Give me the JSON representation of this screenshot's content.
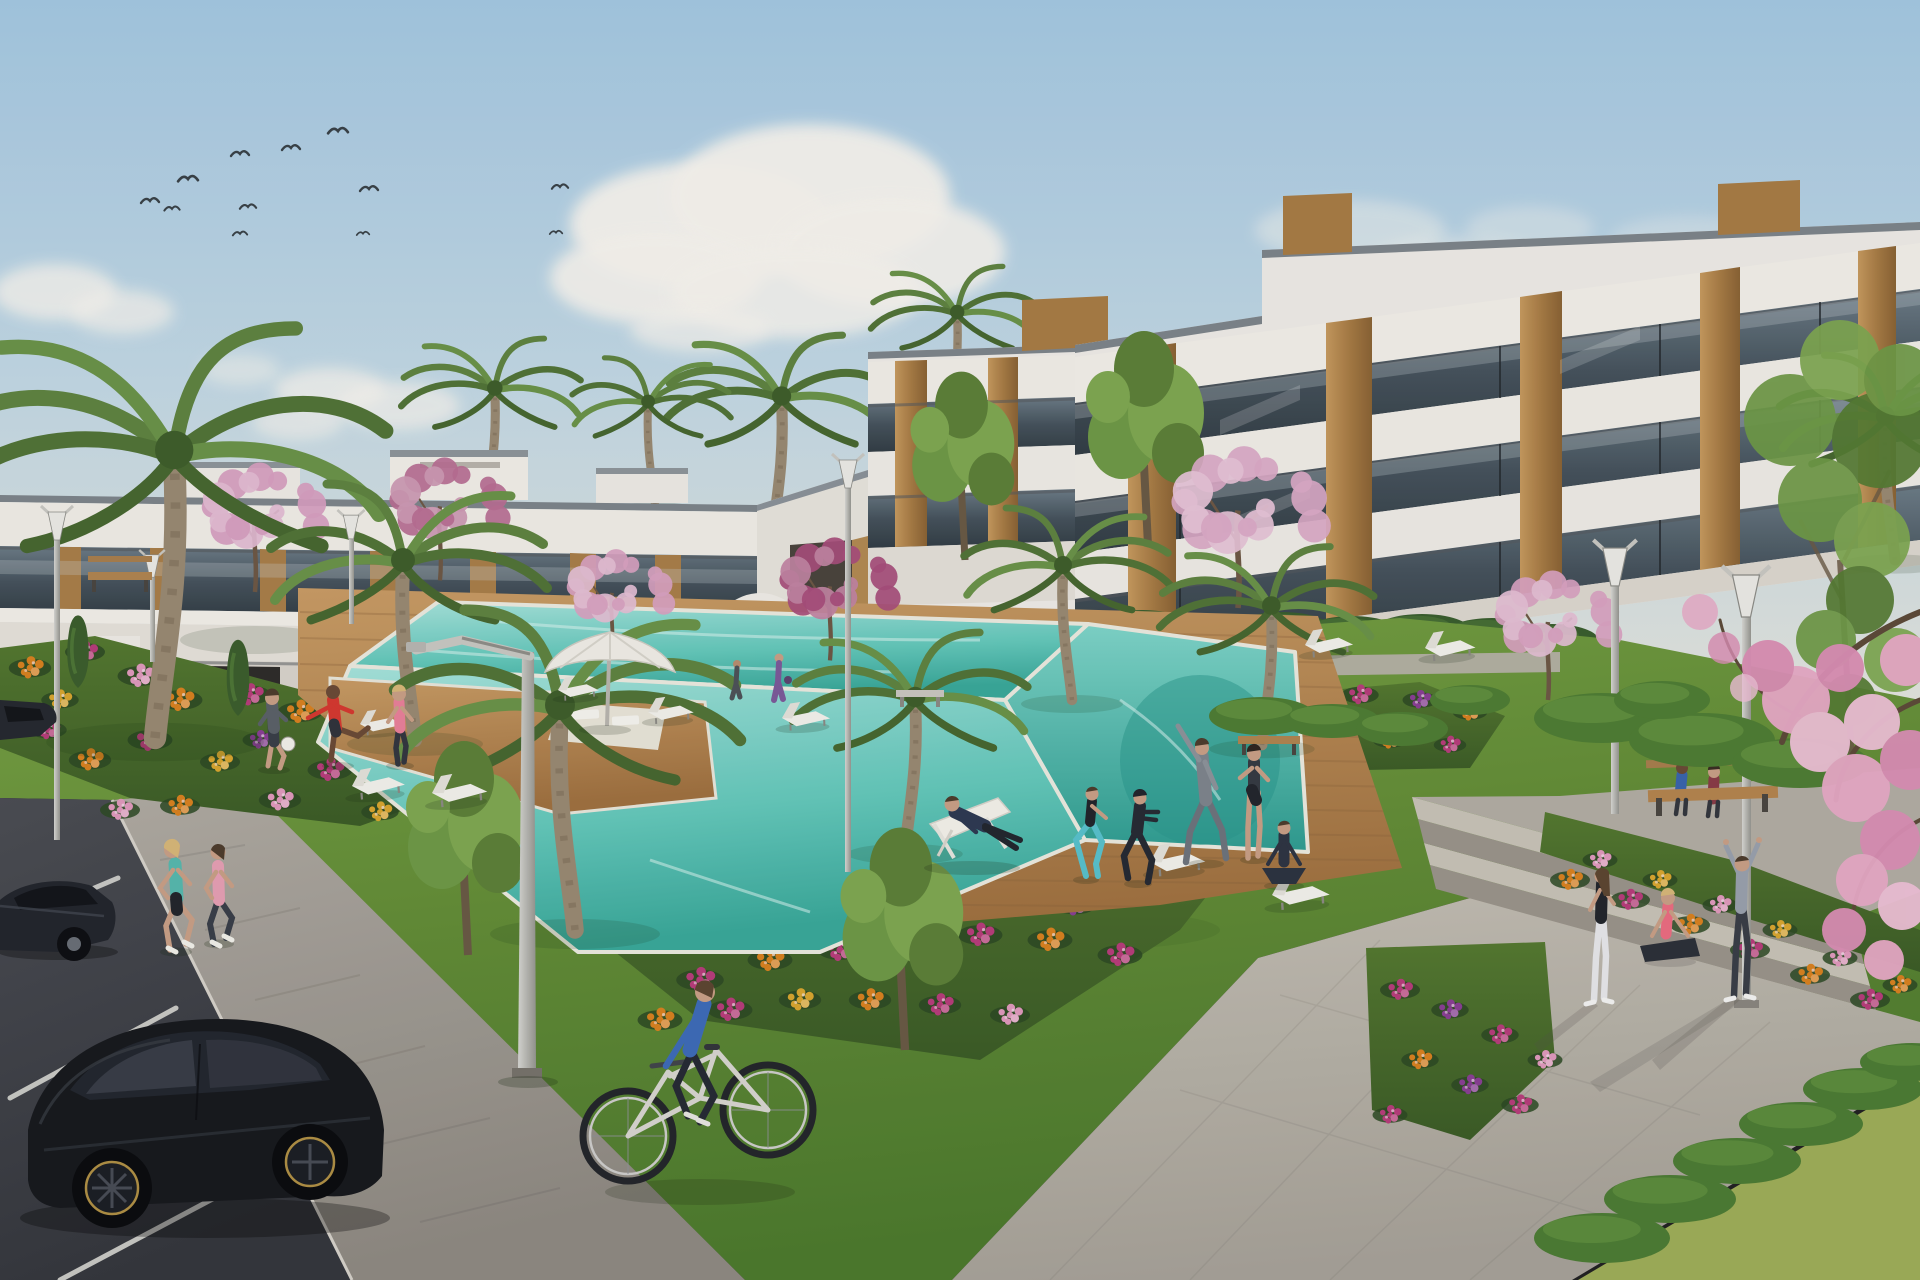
{
  "meta": {
    "title": "Residential complex architectural render",
    "description": "Sunny 3D architectural rendering of a modern white apartment complex with glass balconies and wood panels, communal garden, turquoise swimming pool with wooden deck, flower beds, palm and cherry-blossom trees, parking with black cars, joggers, a cyclist and residents exercising on the lawn."
  },
  "labels": {
    "sky": "blue sky with clouds and birds",
    "building_left": "two-storey white apartment wing",
    "building_right": "three-storey white apartment building",
    "pool": "communal swimming pool with wooden deck",
    "garden": "landscaped lawn and flower beds",
    "parking": "parking lot with dark cars",
    "plaza": "paved plaza with steps",
    "people": "residents exercising, jogging and relaxing"
  },
  "palette": {
    "sky_top": "#a6c9e2",
    "sky_low": "#dde4e2",
    "white_wall": "#f0ede6",
    "wall_shade": "#d9d4cb",
    "glass": "#4a5862",
    "wood": "#b98a50",
    "lawn": "#6f9a3e",
    "hedge_dark": "#3a5e2d",
    "hedge_bright": "#4f7d33",
    "deck": "#b88856",
    "water": "#5cc4b6",
    "pavement": "#b7b2a8",
    "asphalt": "#42444a",
    "blossom": "#d9a0bd",
    "car": "#17191d"
  },
  "scene": {
    "flower_colors": {
      "o": "#d9821f",
      "m": "#b83d7a",
      "p": "#e09abc",
      "u": "#8a3f93",
      "g": "#d9a62e",
      "c": "#c24a5e"
    },
    "clouds": [
      [
        700,
        225,
        130,
        62,
        0.95
      ],
      [
        810,
        196,
        140,
        72,
        0.95
      ],
      [
        890,
        252,
        115,
        55,
        0.9
      ],
      [
        655,
        278,
        105,
        46,
        0.9
      ],
      [
        795,
        292,
        125,
        46,
        0.85
      ],
      [
        700,
        330,
        70,
        22,
        0.7
      ],
      [
        55,
        292,
        62,
        28,
        0.8
      ],
      [
        122,
        312,
        52,
        22,
        0.7
      ],
      [
        330,
        390,
        56,
        22,
        0.75
      ],
      [
        398,
        406,
        62,
        24,
        0.7
      ],
      [
        298,
        422,
        46,
        18,
        0.6
      ],
      [
        1000,
        386,
        46,
        16,
        0.5
      ],
      [
        1062,
        400,
        42,
        14,
        0.45
      ],
      [
        1350,
        230,
        95,
        30,
        0.45
      ],
      [
        1455,
        262,
        85,
        26,
        0.4
      ],
      [
        1530,
        228,
        64,
        22,
        0.35
      ],
      [
        1690,
        240,
        80,
        24,
        0.3
      ],
      [
        240,
        370,
        40,
        16,
        0.5
      ]
    ],
    "birds": [
      [
        150,
        200,
        1
      ],
      [
        188,
        178,
        1.1
      ],
      [
        172,
        208,
        0.85
      ],
      [
        240,
        153,
        1
      ],
      [
        248,
        206,
        0.9
      ],
      [
        291,
        147,
        1
      ],
      [
        338,
        130,
        1.1
      ],
      [
        369,
        188,
        1
      ],
      [
        240,
        233,
        0.8
      ],
      [
        363,
        233,
        0.7
      ],
      [
        560,
        186,
        0.9
      ],
      [
        556,
        232,
        0.7
      ]
    ],
    "palms_bg": [
      [
        772,
        540,
        1.6,
        1
      ],
      [
        950,
        420,
        1.2,
        1
      ],
      [
        655,
        505,
        1.15,
        -1
      ],
      [
        487,
        505,
        1.3,
        1
      ]
    ],
    "palms_fg": [
      [
        155,
        738,
        3.2,
        1
      ],
      [
        415,
        740,
        2.0,
        -1
      ],
      [
        575,
        930,
        2.5,
        -1
      ],
      [
        905,
        850,
        1.7,
        1
      ],
      [
        1072,
        700,
        1.5,
        -1
      ],
      [
        1262,
        745,
        1.55,
        1
      ],
      [
        1895,
        560,
        1.6,
        -1
      ]
    ],
    "blossoms": [
      [
        255,
        520,
        1.0,
        "#d79fc0"
      ],
      [
        440,
        512,
        0.95,
        "#b96f92"
      ],
      [
        612,
        598,
        0.85,
        "#d9a3c1"
      ],
      [
        830,
        592,
        0.95,
        "#a84f7b"
      ],
      [
        1238,
        518,
        1.25,
        "#dcaac6"
      ],
      [
        1548,
        628,
        1.0,
        "#d9a3c1"
      ]
    ],
    "greens_bg": [
      [
        965,
        560,
        1.1
      ],
      [
        1148,
        545,
        1.25
      ]
    ],
    "greens_fg": [
      [
        468,
        955,
        1.25
      ],
      [
        905,
        1050,
        1.3
      ]
    ],
    "conifers": [
      [
        78,
        688,
        1
      ],
      [
        238,
        716,
        1.05
      ],
      [
        398,
        754,
        1.1
      ],
      [
        478,
        788,
        1.0
      ],
      [
        560,
        708,
        0.8
      ],
      [
        1005,
        700,
        0.7
      ]
    ],
    "hedges_dark": [
      [
        722,
        626,
        46,
        17
      ],
      [
        792,
        631,
        50,
        19
      ],
      [
        862,
        626,
        47,
        17
      ],
      [
        932,
        630,
        51,
        19
      ],
      [
        1002,
        626,
        47,
        17
      ],
      [
        1072,
        631,
        51,
        19
      ],
      [
        1142,
        627,
        49,
        17
      ],
      [
        1212,
        633,
        51,
        19
      ],
      [
        1282,
        629,
        49,
        17
      ],
      [
        1352,
        635,
        51,
        19
      ],
      [
        1422,
        631,
        49,
        17
      ],
      [
        1492,
        637,
        51,
        19
      ],
      [
        1552,
        641,
        47,
        17
      ],
      [
        22,
        718,
        58,
        21
      ],
      [
        112,
        724,
        63,
        23
      ],
      [
        212,
        728,
        60,
        21
      ],
      [
        312,
        734,
        62,
        23
      ],
      [
        412,
        740,
        58,
        21
      ],
      [
        502,
        738,
        53,
        19
      ],
      [
        592,
        733,
        48,
        17
      ],
      [
        662,
        728,
        43,
        15
      ]
    ],
    "hedges_bright": [
      [
        1602,
        718,
        68,
        25
      ],
      [
        1702,
        740,
        73,
        27
      ],
      [
        1800,
        763,
        68,
        25
      ],
      [
        1662,
        700,
        48,
        19
      ],
      [
        1262,
        716,
        53,
        19
      ],
      [
        1332,
        721,
        48,
        17
      ],
      [
        1402,
        729,
        46,
        17
      ],
      [
        1470,
        700,
        40,
        15
      ]
    ],
    "hedges_corner": [
      [
        1602,
        1238,
        68,
        25
      ],
      [
        1670,
        1199,
        66,
        24
      ],
      [
        1737,
        1161,
        64,
        23
      ],
      [
        1801,
        1124,
        62,
        22
      ],
      [
        1863,
        1089,
        60,
        21
      ],
      [
        1912,
        1062,
        52,
        19
      ]
    ],
    "flowers": [
      [
        30,
        668,
        17,
        "o"
      ],
      [
        85,
        652,
        16,
        "m"
      ],
      [
        140,
        676,
        18,
        "p"
      ],
      [
        60,
        700,
        15,
        "g"
      ],
      [
        180,
        700,
        18,
        "o"
      ],
      [
        250,
        695,
        17,
        "m"
      ],
      [
        300,
        712,
        18,
        "o"
      ],
      [
        360,
        730,
        17,
        "p"
      ],
      [
        150,
        740,
        18,
        "m"
      ],
      [
        90,
        760,
        17,
        "o"
      ],
      [
        220,
        762,
        16,
        "g"
      ],
      [
        330,
        770,
        18,
        "m"
      ],
      [
        420,
        760,
        16,
        "o"
      ],
      [
        460,
        788,
        16,
        "m"
      ],
      [
        280,
        800,
        17,
        "p"
      ],
      [
        180,
        806,
        16,
        "o"
      ],
      [
        380,
        812,
        15,
        "g"
      ],
      [
        120,
        810,
        16,
        "p"
      ],
      [
        48,
        730,
        15,
        "m"
      ],
      [
        260,
        740,
        14,
        "u"
      ],
      [
        700,
        880,
        20,
        "m"
      ],
      [
        760,
        840,
        19,
        "o"
      ],
      [
        820,
        800,
        18,
        "p"
      ],
      [
        880,
        790,
        18,
        "m"
      ],
      [
        940,
        780,
        18,
        "o"
      ],
      [
        1000,
        775,
        18,
        "m"
      ],
      [
        1060,
        770,
        17,
        "g"
      ],
      [
        1120,
        780,
        18,
        "m"
      ],
      [
        1180,
        790,
        18,
        "o"
      ],
      [
        1240,
        805,
        18,
        "m"
      ],
      [
        680,
        930,
        19,
        "o"
      ],
      [
        740,
        900,
        18,
        "p"
      ],
      [
        800,
        880,
        18,
        "g"
      ],
      [
        860,
        860,
        18,
        "m"
      ],
      [
        920,
        850,
        18,
        "o"
      ],
      [
        980,
        840,
        17,
        "p"
      ],
      [
        1040,
        835,
        18,
        "m"
      ],
      [
        1100,
        845,
        18,
        "o"
      ],
      [
        1160,
        860,
        18,
        "m"
      ],
      [
        1220,
        880,
        18,
        "p"
      ],
      [
        700,
        980,
        19,
        "m"
      ],
      [
        770,
        960,
        18,
        "o"
      ],
      [
        840,
        950,
        18,
        "m"
      ],
      [
        910,
        940,
        17,
        "g"
      ],
      [
        980,
        935,
        18,
        "m"
      ],
      [
        1050,
        940,
        18,
        "o"
      ],
      [
        1120,
        955,
        18,
        "m"
      ],
      [
        660,
        1020,
        18,
        "o"
      ],
      [
        730,
        1010,
        18,
        "m"
      ],
      [
        800,
        1000,
        17,
        "g"
      ],
      [
        870,
        1000,
        17,
        "o"
      ],
      [
        940,
        1005,
        17,
        "m"
      ],
      [
        1010,
        1015,
        16,
        "p"
      ],
      [
        1075,
        905,
        17,
        "u"
      ],
      [
        945,
        895,
        16,
        "u"
      ],
      [
        1240,
        710,
        15,
        "u"
      ],
      [
        1300,
        700,
        15,
        "o"
      ],
      [
        1360,
        695,
        15,
        "m"
      ],
      [
        1420,
        700,
        14,
        "u"
      ],
      [
        1470,
        712,
        14,
        "o"
      ],
      [
        1270,
        740,
        14,
        "m"
      ],
      [
        1330,
        735,
        14,
        "u"
      ],
      [
        1390,
        740,
        14,
        "o"
      ],
      [
        1450,
        745,
        13,
        "m"
      ],
      [
        1570,
        880,
        16,
        "o"
      ],
      [
        1630,
        900,
        16,
        "m"
      ],
      [
        1690,
        925,
        16,
        "o"
      ],
      [
        1750,
        950,
        16,
        "m"
      ],
      [
        1810,
        975,
        16,
        "o"
      ],
      [
        1870,
        1000,
        16,
        "m"
      ],
      [
        1600,
        860,
        14,
        "p"
      ],
      [
        1660,
        880,
        14,
        "g"
      ],
      [
        1720,
        905,
        14,
        "p"
      ],
      [
        1780,
        930,
        14,
        "g"
      ],
      [
        1840,
        958,
        14,
        "p"
      ],
      [
        1900,
        985,
        14,
        "o"
      ],
      [
        1400,
        990,
        16,
        "m"
      ],
      [
        1450,
        1010,
        15,
        "u"
      ],
      [
        1500,
        1035,
        15,
        "m"
      ],
      [
        1420,
        1060,
        15,
        "o"
      ],
      [
        1470,
        1085,
        15,
        "u"
      ],
      [
        1520,
        1105,
        15,
        "m"
      ],
      [
        1545,
        1060,
        14,
        "p"
      ],
      [
        1390,
        1115,
        14,
        "m"
      ]
    ],
    "loungers": [
      [
        648,
        712,
        0.95,
        -3
      ],
      [
        782,
        718,
        1.0,
        -3
      ],
      [
        1305,
        645,
        1.0,
        -4
      ],
      [
        1425,
        648,
        1.05,
        -4
      ],
      [
        352,
        786,
        1.1,
        -5
      ],
      [
        432,
        793,
        1.15,
        -5
      ],
      [
        1150,
        862,
        1.15,
        -4
      ],
      [
        1272,
        895,
        1.2,
        -4
      ],
      [
        360,
        724,
        0.9,
        -3
      ],
      [
        558,
        690,
        0.85,
        -3
      ]
    ],
    "deck_lines": 13,
    "counts": {
      "birds": 12,
      "cars": 3,
      "street_lamps": 7,
      "sun_loungers": 10,
      "people": 18
    }
  }
}
